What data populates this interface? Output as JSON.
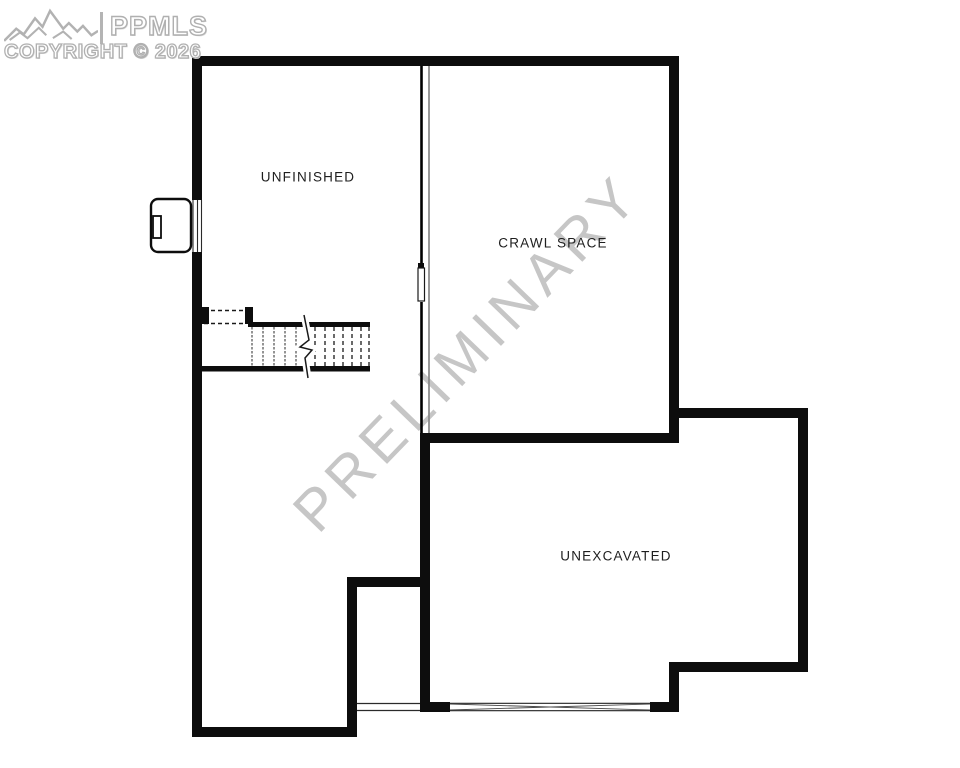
{
  "logo": {
    "brand": "PPMLS",
    "copyright": "COPYRIGHT © 2026",
    "icon": "mountain-range-icon",
    "emboss_color": "#b0b0b0"
  },
  "floorplan": {
    "preliminary_watermark": "PRELIMINARY",
    "watermark_color": "#c6c6c6",
    "wall_color": "#0d0d0d",
    "rooms": [
      {
        "label": "UNFINISHED"
      },
      {
        "label": "CRAWL SPACE"
      },
      {
        "label": "UNEXCAVATED"
      }
    ]
  }
}
